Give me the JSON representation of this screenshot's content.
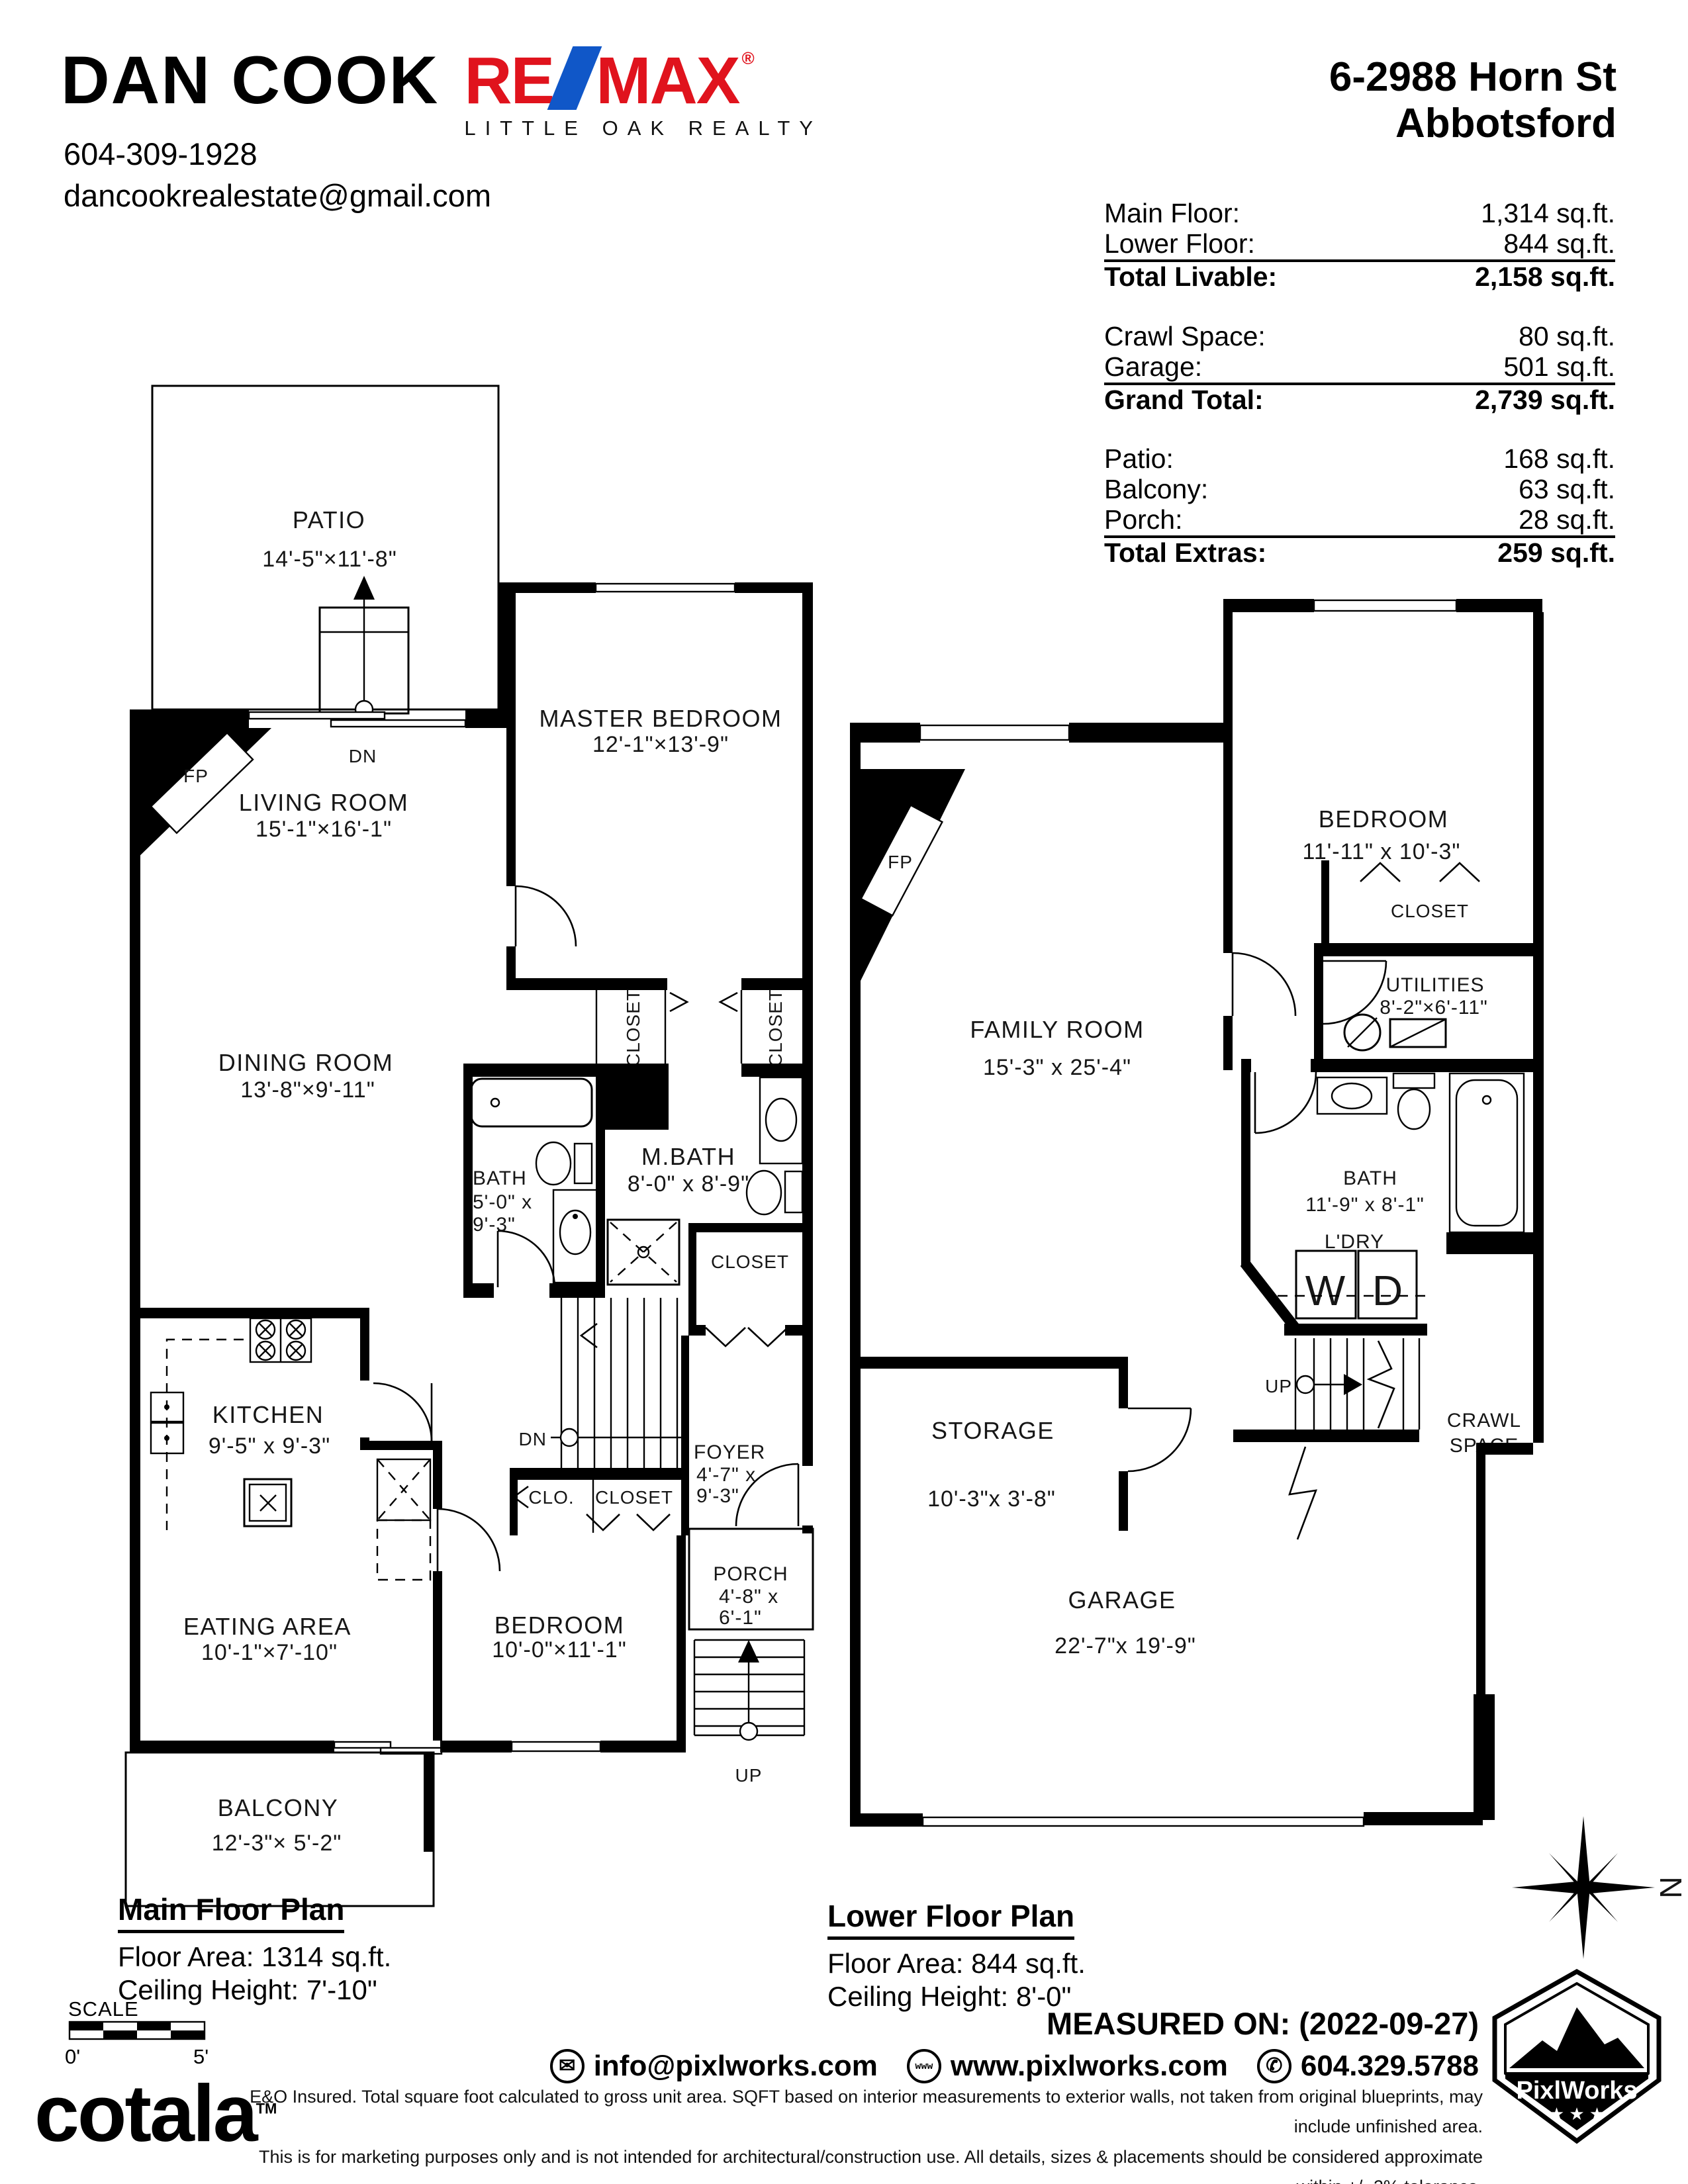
{
  "header": {
    "agent": "DAN COOK",
    "phone": "604-309-1928",
    "email": "dancookrealestate@gmail.com",
    "brand_re": "RE",
    "brand_max": "MAX",
    "brand_reg": "®",
    "brand_sub": "LITTLE OAK REALTY",
    "brand_red": "#e0131d",
    "brand_blue": "#1057c8",
    "address1": "6-2988 Horn St",
    "address2": "Abbotsford"
  },
  "areas": {
    "groups": [
      {
        "rows": [
          {
            "label": "Main Floor:",
            "value": "1,314 sq.ft."
          },
          {
            "label": "Lower Floor:",
            "value": "844 sq.ft."
          }
        ],
        "total": {
          "label": "Total Livable:",
          "value": "2,158 sq.ft."
        }
      },
      {
        "rows": [
          {
            "label": "Crawl Space:",
            "value": "80 sq.ft."
          },
          {
            "label": "Garage:",
            "value": "501 sq.ft."
          }
        ],
        "total": {
          "label": "Grand Total:",
          "value": "2,739 sq.ft."
        }
      },
      {
        "rows": [
          {
            "label": "Patio:",
            "value": "168 sq.ft."
          },
          {
            "label": "Balcony:",
            "value": "63 sq.ft."
          },
          {
            "label": "Porch:",
            "value": "28 sq.ft."
          }
        ],
        "total": {
          "label": "Total Extras:",
          "value": "259 sq.ft."
        }
      }
    ]
  },
  "main_floor": {
    "caption_title": "Main Floor Plan",
    "caption_area": "Floor Area: 1314 sq.ft.",
    "caption_ceiling": "Ceiling Height: 7'-10\"",
    "patio_name": "PATIO",
    "patio_dims": "14'-5\"×11'-8\"",
    "living_name": "LIVING ROOM",
    "living_dims": "15'-1\"×16'-1\"",
    "master_name": "MASTER BEDROOM",
    "master_dims": "12'-1\"×13'-9\"",
    "dining_name": "DINING ROOM",
    "dining_dims": "13'-8\"×9'-11\"",
    "bath_name": "BATH",
    "bath_dims1": "5'-0\" x",
    "bath_dims2": "9'-3\"",
    "mbath_name": "M.BATH",
    "mbath_dims": "8'-0\" x 8'-9\"",
    "kitchen_name": "KITCHEN",
    "kitchen_dims": "9'-5\" x 9'-3\"",
    "eating_name": "EATING AREA",
    "eating_dims": "10'-1\"×7'-10\"",
    "bedroom_name": "BEDROOM",
    "bedroom_dims": "10'-0\"×11'-1\"",
    "foyer_name": "FOYER",
    "foyer_dims1": "4'-7\" x",
    "foyer_dims2": "9'-3\"",
    "porch_name": "PORCH",
    "porch_dims1": "4'-8\" x",
    "porch_dims2": "6'-1\"",
    "balcony_name": "BALCONY",
    "balcony_dims": "12'-3\"× 5'-2\"",
    "closet_v1": "CLOSET",
    "closet_v2": "CLOSET",
    "closet_mbath": "CLOSET",
    "clo": "CLO.",
    "closet_hall": "CLOSET",
    "fp": "FP",
    "dn_patio": "DN",
    "dn_stairs": "DN",
    "up_porch": "UP"
  },
  "lower_floor": {
    "caption_title": "Lower Floor Plan",
    "caption_area": "Floor Area: 844 sq.ft.",
    "caption_ceiling": "Ceiling Height: 8'-0\"",
    "family_name": "FAMILY ROOM",
    "family_dims": "15'-3\" x 25'-4\"",
    "bedroom_name": "BEDROOM",
    "bedroom_dims": "11'-11\" x 10'-3\"",
    "closet": "CLOSET",
    "utilities_name": "UTILITIES",
    "utilities_dims": "8'-2\"×6'-11\"",
    "bath_name": "BATH",
    "bath_dims": "11'-9\" x 8'-1\"",
    "ldry": "L'DRY",
    "w": "W",
    "d": "D",
    "storage_name": "STORAGE",
    "storage_dims": "10'-3\"x 3'-8\"",
    "crawl1": "CRAWL",
    "crawl2": "SPACE",
    "garage_name": "GARAGE",
    "garage_dims": "22'-7\"x 19'-9\"",
    "fp": "FP",
    "up": "UP"
  },
  "footer": {
    "scale_label": "SCALE",
    "scale_0": "0'",
    "scale_5": "5'",
    "cotala": "cotala",
    "tm": "TM",
    "measured": "MEASURED ON: (2022-09-27)",
    "email": "info@pixlworks.com",
    "web": "www.pixlworks.com",
    "phone": "604.329.5788",
    "www_icon": "www",
    "email_icon": "✉",
    "phone_icon": "✆",
    "disclaimer1": "E&O Insured.  Total square foot calculated to gross unit area. SQFT based on interior measurements to exterior walls, not taken from original blueprints, may include unfinished area.",
    "disclaimer2": "This is for marketing purposes only and is not intended for architectural/construction use.  All details, sizes & placements should be considered approximate within +/- 2%  tolerance.",
    "pixlworks": "PixlWorks",
    "compass_n": "N"
  }
}
